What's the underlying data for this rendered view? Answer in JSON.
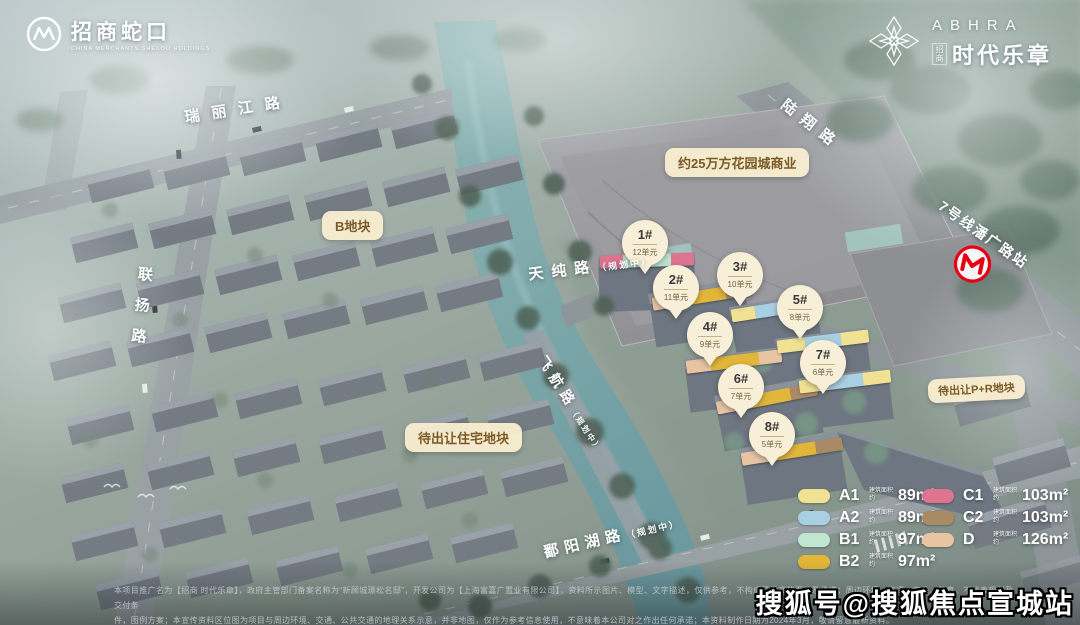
{
  "brand": {
    "developer": {
      "name": "招商蛇口",
      "sub": "CHINA MERCHANTS SHEKOU HOLDINGS"
    },
    "project": {
      "latin": "ABHRA",
      "prefix": "招商",
      "name": "时代乐章"
    }
  },
  "colors": {
    "A1": "#f1e193",
    "A2": "#a9cfe2",
    "B1": "#bfe6cf",
    "B2": "#e2b638",
    "C1": "#dd7590",
    "C2": "#a88a64",
    "D": "#e9c4a3",
    "label_bg": "#f8edd0",
    "label_text": "#7b5a26",
    "metro_red": "#e60012"
  },
  "roads": {
    "ruilijiang": "瑞丽江路",
    "luxiang": "陆翔路",
    "lianyang": "联扬路",
    "tianchun": "天纯路",
    "tianchun_status": "（规划中）",
    "feihang": "飞航路",
    "feihang_status": "（规划中）",
    "poyanghu": "鄱阳湖路",
    "poyanghu_status": "（规划中）"
  },
  "areas": {
    "plot_b": "B地块",
    "mall": "约25万方花园城商业",
    "residential_pending": "待出让住宅地块",
    "pr_pending": "待出让P+R地块"
  },
  "metro": {
    "station": "7号线潘广路站"
  },
  "buildings": [
    {
      "no": "1#",
      "units": "12单元",
      "roof": [
        "C1",
        "B1",
        "C1"
      ]
    },
    {
      "no": "2#",
      "units": "11单元",
      "roof": [
        "D",
        "B2",
        "C2"
      ]
    },
    {
      "no": "3#",
      "units": "10单元",
      "roof": [
        "A1",
        "A2",
        "A1"
      ]
    },
    {
      "no": "4#",
      "units": "9单元",
      "roof": [
        "D",
        "B2",
        "D"
      ]
    },
    {
      "no": "5#",
      "units": "8单元",
      "roof": [
        "A1",
        "A2",
        "A1"
      ]
    },
    {
      "no": "6#",
      "units": "7单元",
      "roof": [
        "D",
        "B2",
        "C2"
      ]
    },
    {
      "no": "7#",
      "units": "6单元",
      "roof": [
        "A1",
        "A2",
        "A1"
      ]
    },
    {
      "no": "8#",
      "units": "5单元",
      "roof": [
        "D",
        "B2",
        "C2"
      ]
    }
  ],
  "legend": {
    "area_prefix": "建筑面积约",
    "items": [
      {
        "type": "A1",
        "area": "89m²",
        "color": "#f1e193"
      },
      {
        "type": "A2",
        "area": "89m²",
        "color": "#a9cfe2"
      },
      {
        "type": "B1",
        "area": "97m²",
        "color": "#bfe6cf"
      },
      {
        "type": "B2",
        "area": "97m²",
        "color": "#e2b638"
      },
      {
        "type": "C1",
        "area": "103m²",
        "color": "#dd7590"
      },
      {
        "type": "C2",
        "area": "103m²",
        "color": "#a88a64"
      },
      {
        "type": "D",
        "area": "126m²",
        "color": "#e9c4a3"
      }
    ]
  },
  "footer": {
    "disclaimer1": "本项目推广名为【招商 时代乐章】，政府主管部门备案名称为“新顾城璟松名邸”，开发公司为【上海富嘉广置业有限公司】，资料所示图片、模型、文字描述，仅供参考，不构成开发商的要约及承诺；周边环境、交通、商业、教育，不代表规划及交付条",
    "disclaimer2": "件，图例方案；本宣传资料区位图为项目与周边环境、交通、公共交通的地理关系示意，并非地图，仅作为参考信息使用，不意味着本公司对之作出任何承诺；本资料制作日期为2024年3月，敬请留意最新资料。",
    "watermark": "搜狐号@搜狐焦点宣城站"
  }
}
